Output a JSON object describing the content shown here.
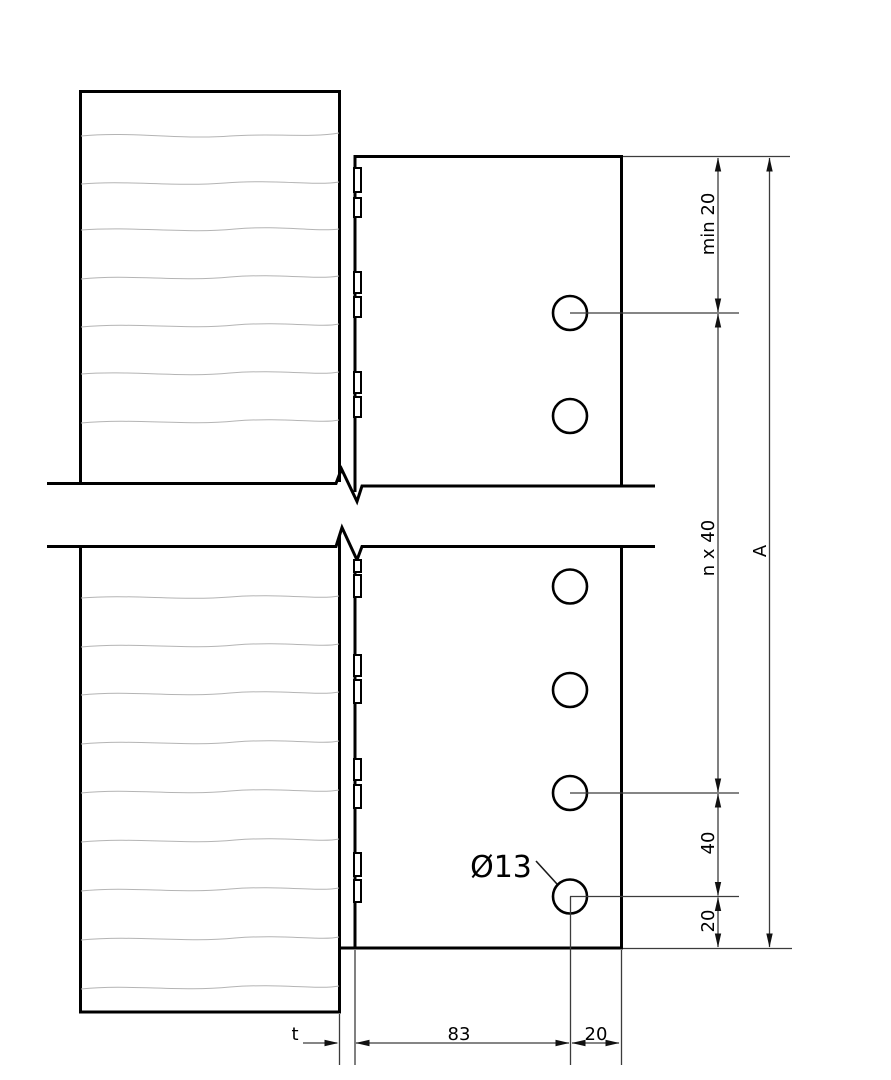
{
  "drawing": {
    "annotation": {
      "hole_diameter_label": "Ø13"
    },
    "dims_right": [
      {
        "id": "top-edge-distance",
        "label": "min 20",
        "orientation": "vertical"
      },
      {
        "id": "bolt-row-spacing-run",
        "label": "n x 40",
        "orientation": "vertical"
      },
      {
        "id": "bolt-row-spacing",
        "label": "40",
        "orientation": "vertical"
      },
      {
        "id": "bottom-edge-distance",
        "label": "20",
        "orientation": "vertical"
      },
      {
        "id": "total-length",
        "label": "A",
        "orientation": "vertical"
      }
    ],
    "dims_bottom": [
      {
        "id": "thickness",
        "label": "t",
        "orientation": "horizontal"
      },
      {
        "id": "bolt-line-offset",
        "label": "83",
        "orientation": "horizontal"
      },
      {
        "id": "end-distance",
        "label": "20",
        "orientation": "horizontal"
      }
    ],
    "holes_visible": 6,
    "colors": {
      "outline": "#000000",
      "dimension_line": "#3c3c3c",
      "grain_line": "#b4b4b4",
      "background": "#ffffff"
    }
  }
}
